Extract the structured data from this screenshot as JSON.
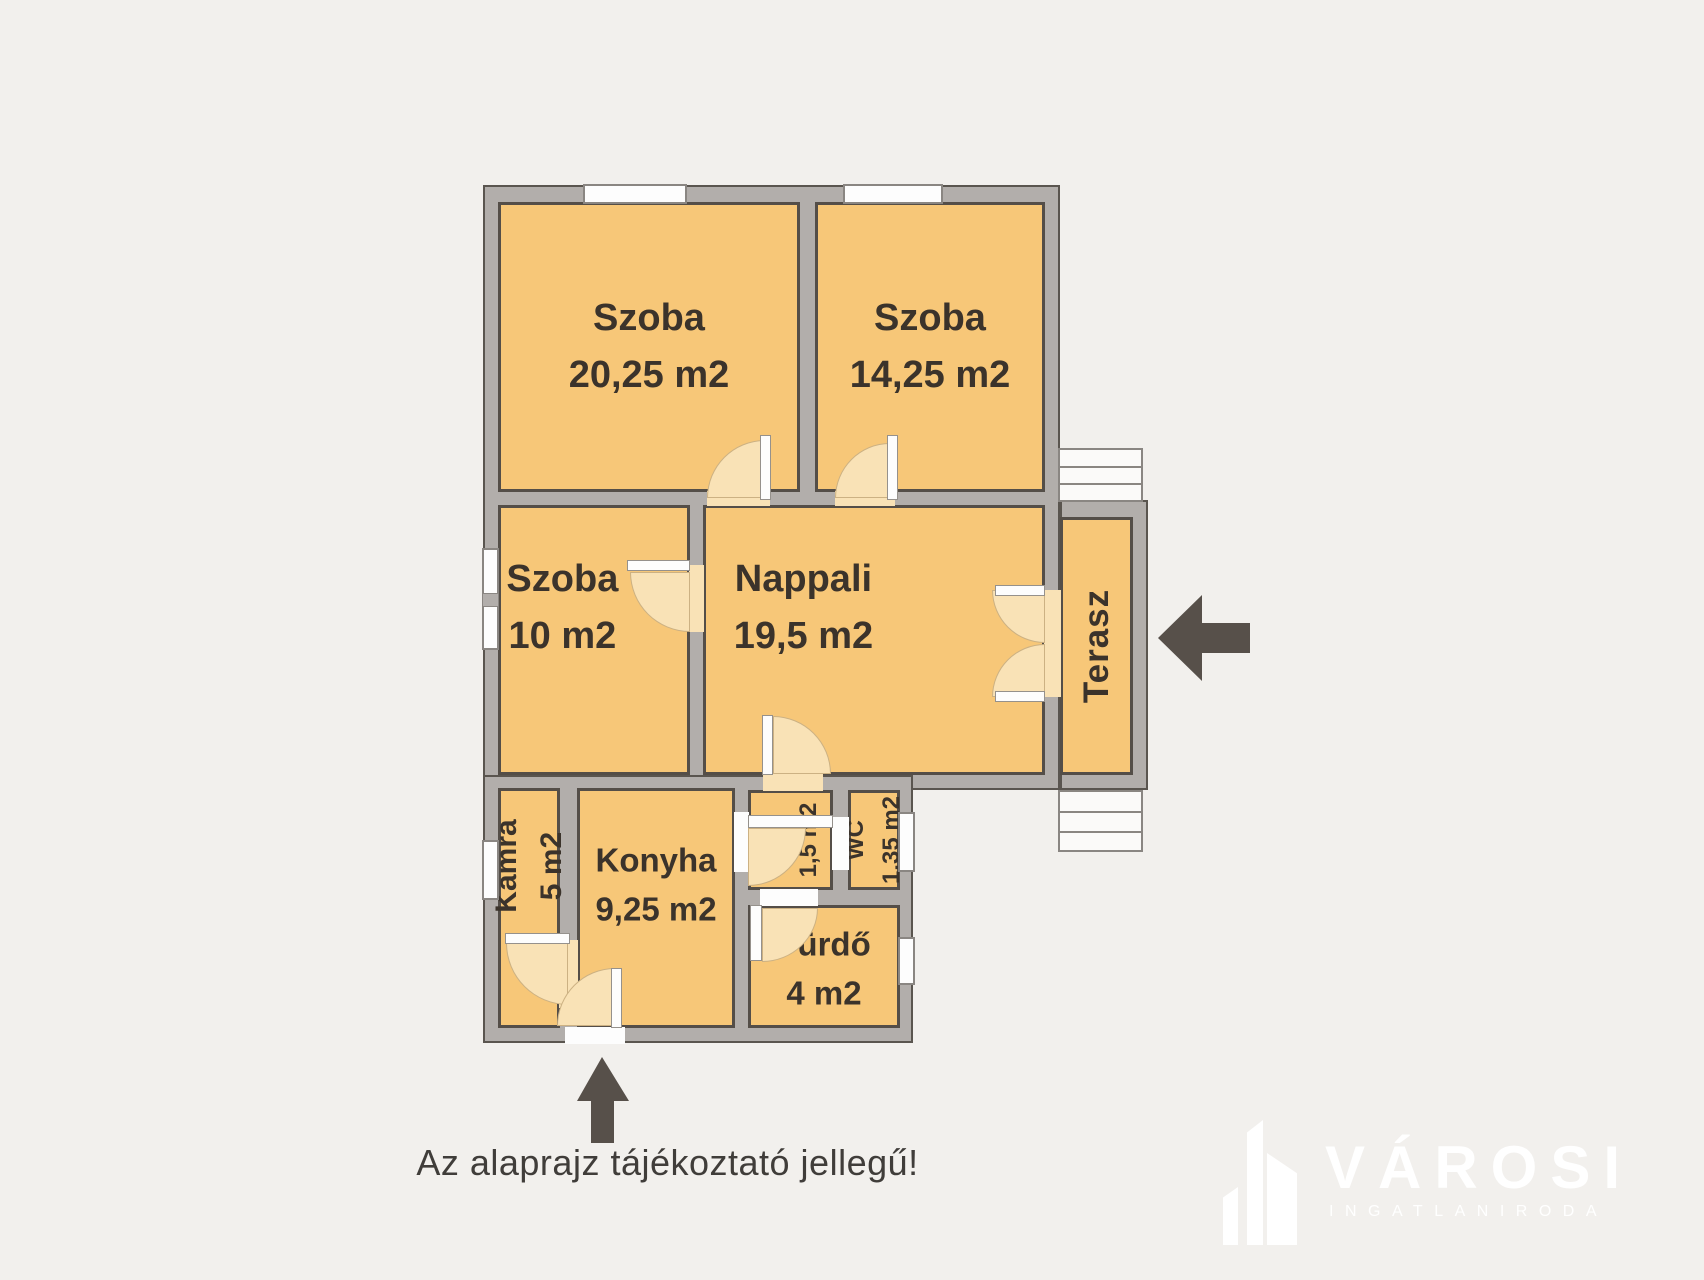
{
  "floorplan": {
    "rooms": [
      {
        "label": "Szoba",
        "area": "20,25 m2"
      },
      {
        "label": "Szoba",
        "area": "14,25 m2"
      },
      {
        "label": "Szoba",
        "area": "10 m2"
      },
      {
        "label": "Nappali",
        "area": "19,5 m2"
      },
      {
        "label": "Terasz",
        "area": ""
      },
      {
        "label": "Kamra",
        "area": "5 m2"
      },
      {
        "label": "Konyha",
        "area": "9,25 m2"
      },
      {
        "label": "Közl",
        "area": "1,5 m2"
      },
      {
        "label": "WC",
        "area": "1,35 m2"
      },
      {
        "label": "Fürdő",
        "area": "4 m2"
      }
    ],
    "disclaimer": "Az alaprajz tájékoztató jellegű!"
  },
  "logo": {
    "name": "VÁROSI",
    "subtitle": "INGATLANIRODA"
  },
  "colors": {
    "bg": "#f2f0ed",
    "wall": "#b2aeab",
    "outline": "#5a554f",
    "room": "#f7c778",
    "room-edge": "#544e48",
    "arc": "#f9e2b6",
    "label": "#3b332b",
    "arrow": "#57504a"
  }
}
